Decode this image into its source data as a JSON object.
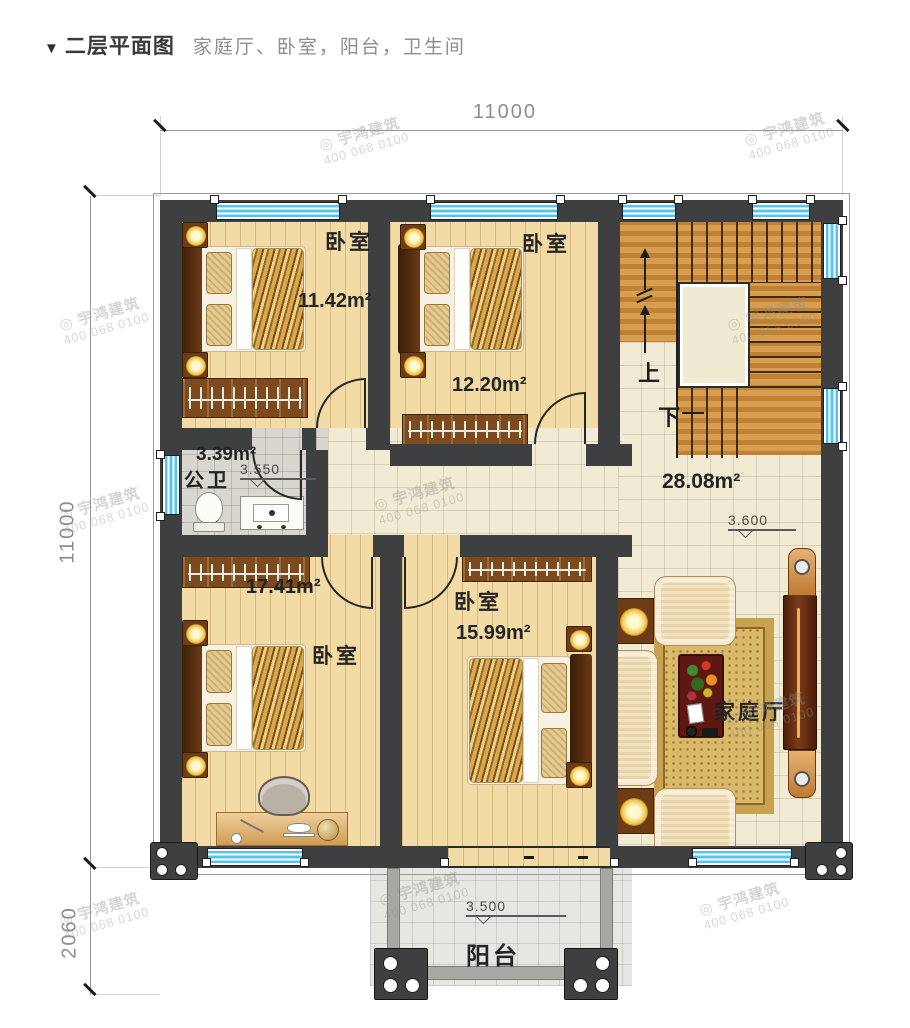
{
  "header": {
    "marker": "▼",
    "title": "二层平面图",
    "subtitle": "家庭厅、卧室，阳台，卫生间"
  },
  "watermark": {
    "logo_glyph": "◎",
    "brand": "宇鸿建筑",
    "phone": "400 068 0100"
  },
  "dims": {
    "top": "11000",
    "left": "11000",
    "bottom_left": "2060"
  },
  "rooms": {
    "bedroom_top_left": {
      "name": "卧室",
      "area": "11.42m²"
    },
    "bedroom_top_mid": {
      "name": "卧室",
      "area": "12.20m²"
    },
    "bathroom": {
      "name": "公卫",
      "area": "3.39m²",
      "level": "3.550"
    },
    "hall": {
      "area": "28.08m²",
      "level": "3.600"
    },
    "bedroom_bottom_left": {
      "name": "卧室",
      "area": "17.41m²"
    },
    "bedroom_bottom_mid": {
      "name": "卧室",
      "area": "15.99m²"
    },
    "family_room": {
      "name": "家庭厅"
    },
    "balcony": {
      "name": "阳台",
      "level": "3.500"
    },
    "stairs": {
      "up": "上",
      "down": "下"
    }
  },
  "palette": {
    "wall": "#3e3f40",
    "window_glass": "#55c5ef",
    "wood_floor": "#f3dba6",
    "tile_floor": "#f1ebd4",
    "bath_tile": "#d9d6cf",
    "stair_wood": "#d2913e",
    "balcony_tile": "#e6e6e2"
  }
}
